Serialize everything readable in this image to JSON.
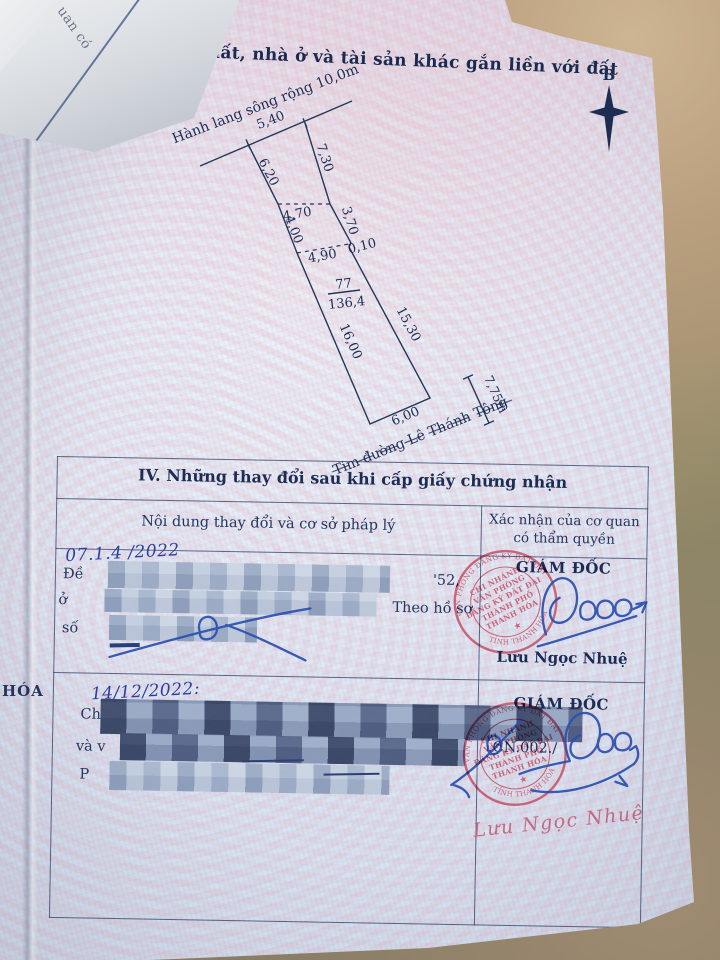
{
  "header": {
    "title": "sơ đồ thửa đất, nhà ở và tài sản khác gắn liền với đất"
  },
  "compass": {
    "label": "B"
  },
  "diagram": {
    "river_label": "Hành lang sông rộng 10,0m",
    "road_label": "Tim đường Lê Thánh Tông",
    "road_offset": "7,75m",
    "parcel_number": "77",
    "parcel_area": "136,4",
    "dims": [
      "5,40",
      "6,20",
      "7,30",
      "4,70",
      "3,70",
      "4,00",
      "4,90",
      "0,10",
      "15,30",
      "16,00",
      "6,00"
    ]
  },
  "margin_text": "HÓA",
  "folded_paper_text": "uan có",
  "section4": {
    "title": "IV. Những thay đổi sau khi cấp giấy chứng nhận",
    "col_left": "Nội dung thay đổi và cơ sở pháp lý",
    "col_right_line1": "Xác nhận của cơ quan",
    "col_right_line2": "có thẩm quyền",
    "row1": {
      "date": "07.1.4 /2022",
      "frag_de": "Đề",
      "frag_52": "'52,",
      "frag_o": "ở",
      "frag_theo": "Theo hồ sơ",
      "frag_so": "số",
      "role": "GIÁM ĐỐC",
      "signer": "Lưu Ngọc Nhuệ"
    },
    "row2": {
      "date": "14/12/2022:",
      "frag_ch": "Ch",
      "frag_vav": "và v",
      "frag_p": "P",
      "frag_cn": ".CN.002./",
      "role": "GIÁM ĐỐC",
      "signer_script": "Lưu Ngọc Nhuệ"
    },
    "stamp": {
      "ring_top": "VĂN PHÒNG ĐĂNG KÝ ĐẤT ĐAI",
      "ring_bottom": "TỈNH THANH HÓA",
      "star": "★",
      "center": [
        "CHI NHÁNH",
        "VĂN PHÒNG",
        "ĐĂNG KÝ ĐẤT ĐAI",
        "THÀNH PHỐ",
        "THANH HÓA"
      ]
    }
  }
}
